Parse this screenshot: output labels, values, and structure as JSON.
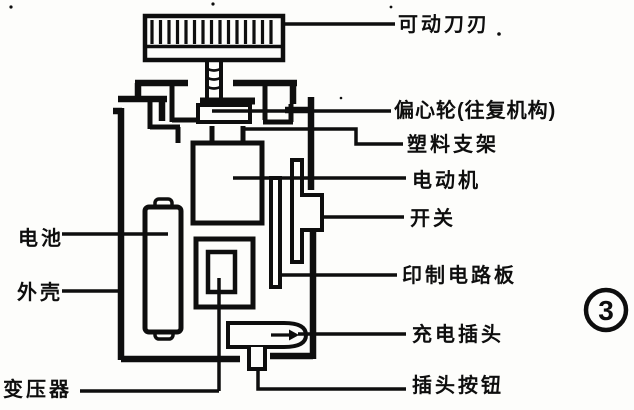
{
  "figure": {
    "kind": "shaver-cross-section-diagram",
    "number": "3"
  },
  "colors": {
    "ink": "#0e0e0e",
    "paper": "#fdfdfb"
  },
  "labels": {
    "movable_blade": "可动刀刃",
    "eccentric_wheel": "偏心轮(往复机构)",
    "plastic_bracket": "塑料支架",
    "motor": "电动机",
    "switch": "开关",
    "pcb": "印制电路板",
    "charging_plug": "充电插头",
    "plug_button": "插头按钮",
    "battery": "电池",
    "case": "外壳",
    "transformer": "变压器"
  }
}
